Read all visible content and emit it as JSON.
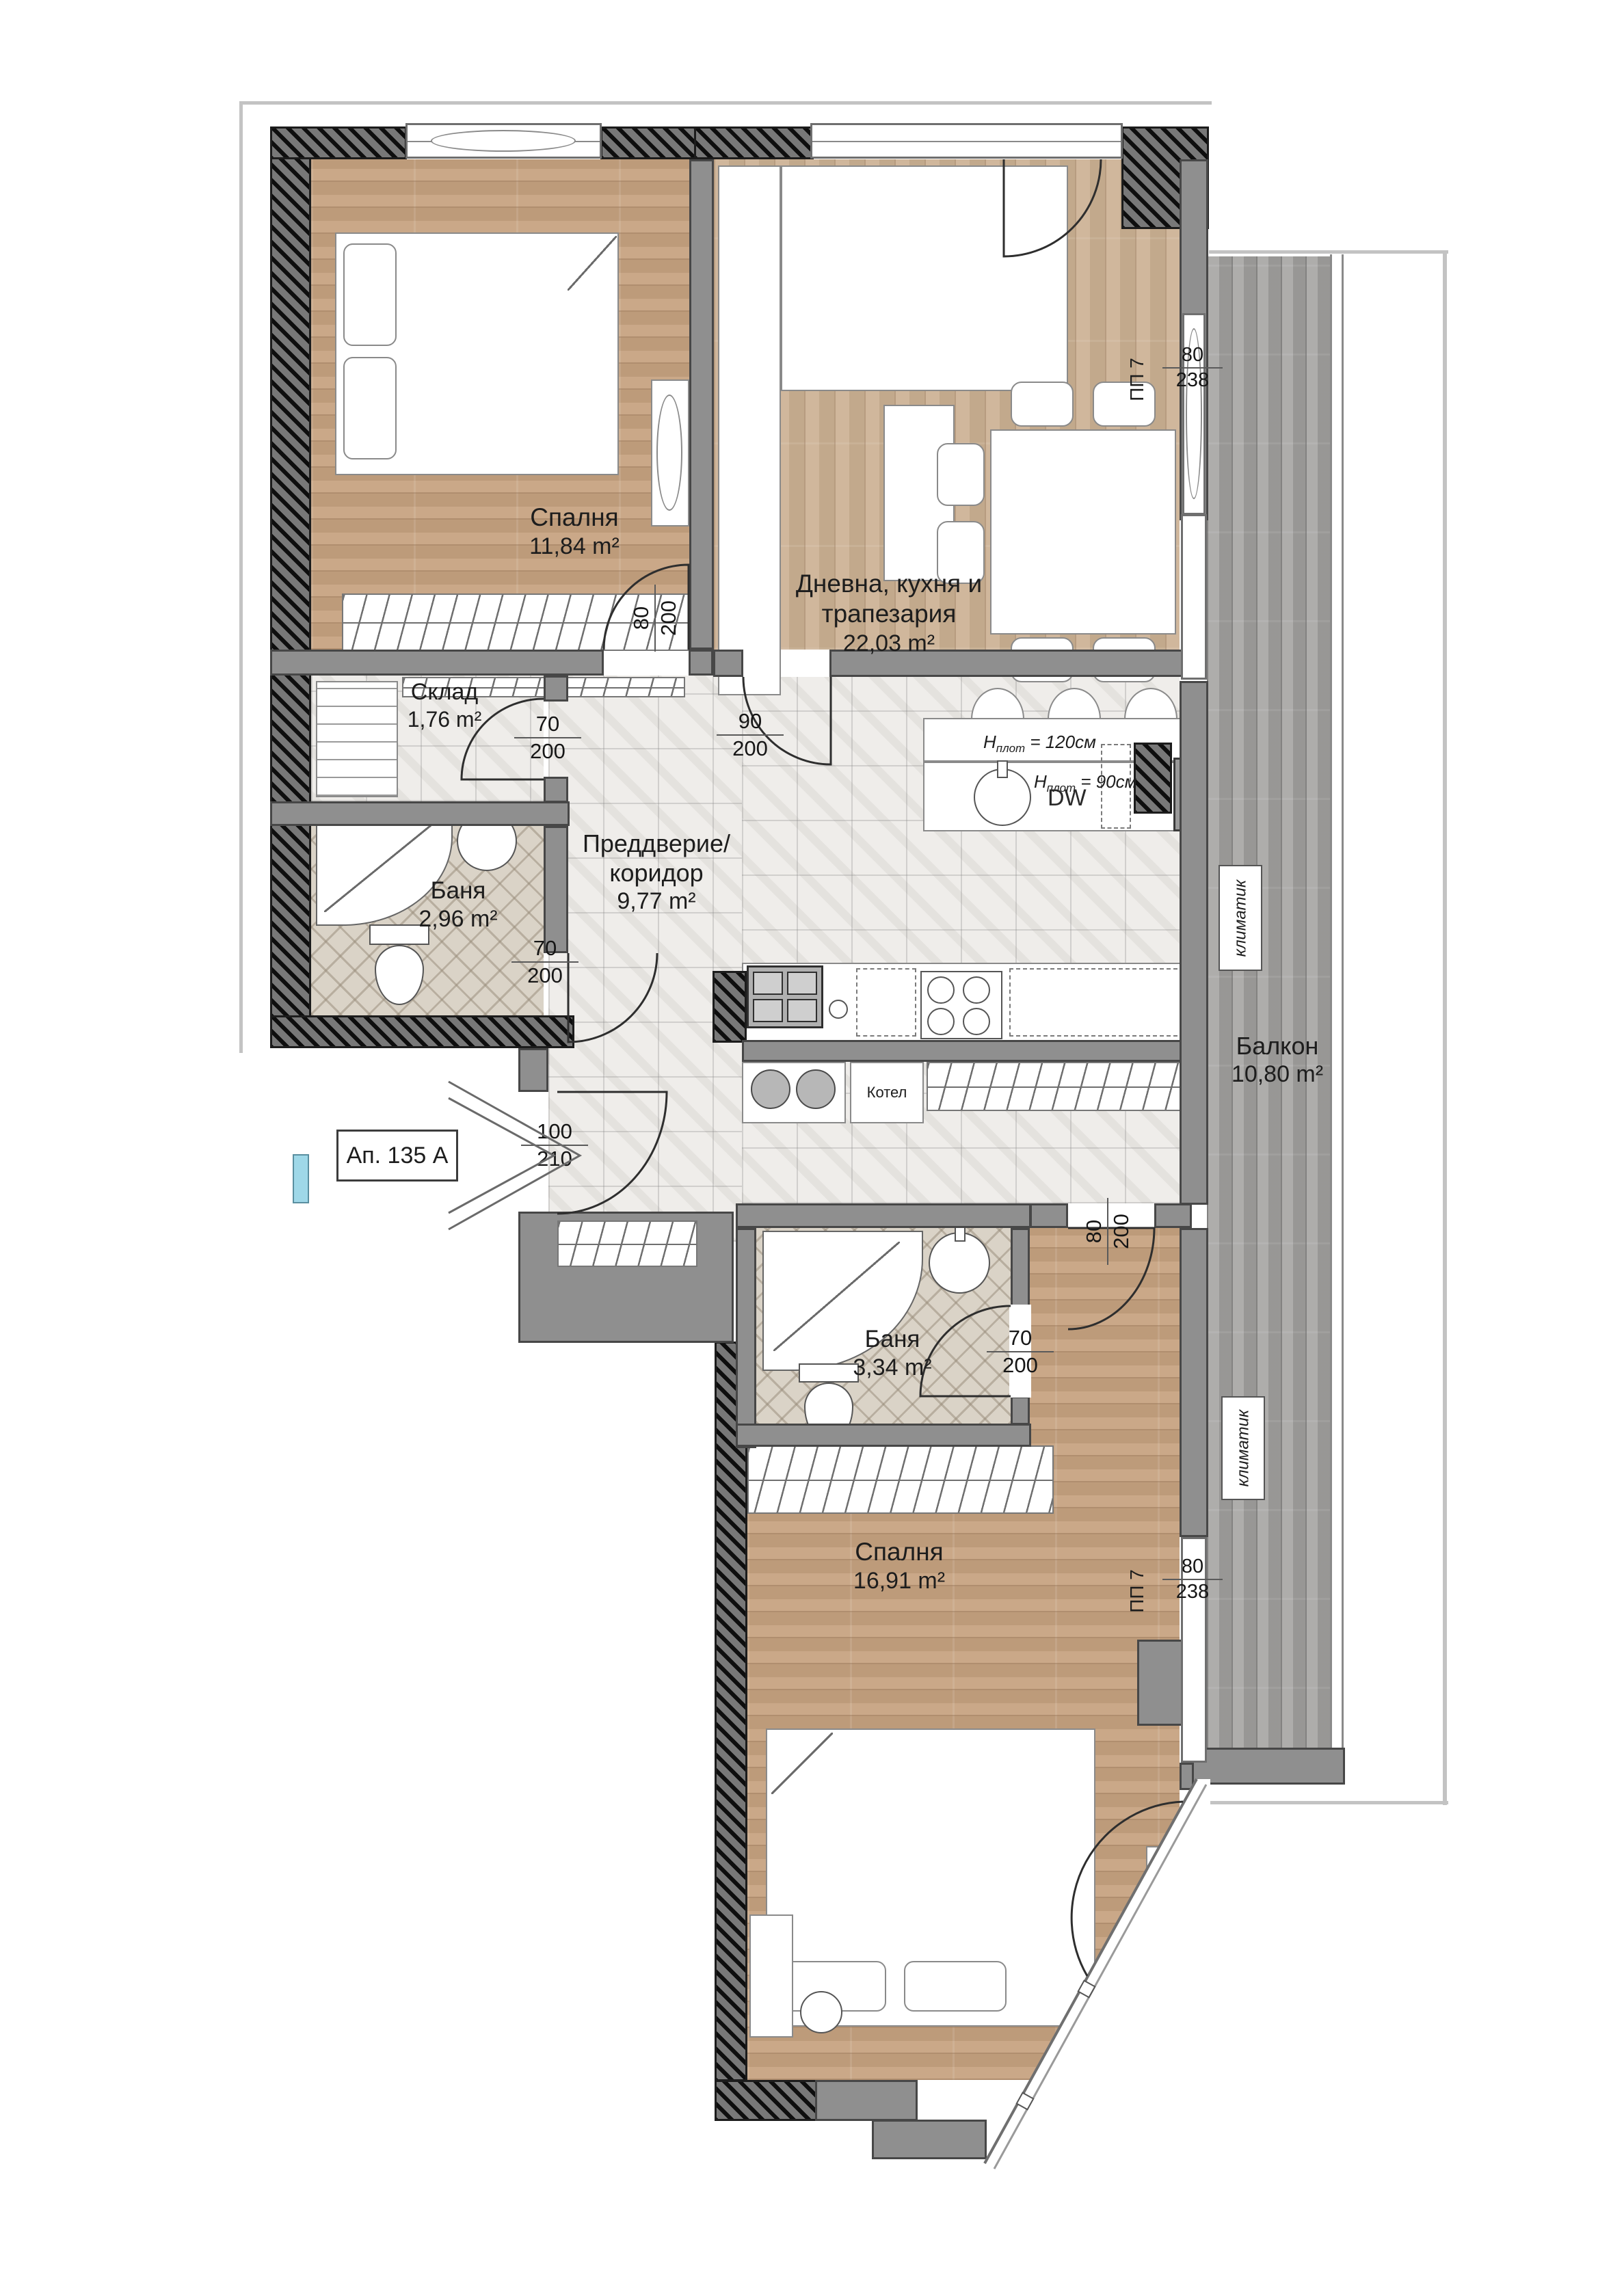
{
  "apartment": {
    "label": "Ап. 135 А"
  },
  "rooms": {
    "bedroom1": {
      "name": "Спалня",
      "area": "11,84 m²"
    },
    "living": {
      "name_line1": "Дневна, кухня и",
      "name_line2": "трапезария",
      "area": "22,03 m²"
    },
    "storage": {
      "name": "Склад",
      "area": "1,76 m²"
    },
    "bath1": {
      "name": "Баня",
      "area": "2,96 m²"
    },
    "hall": {
      "name_line1": "Преддверие/",
      "name_line2": "коридор",
      "area": "9,77 m²"
    },
    "bath2": {
      "name": "Баня",
      "area": "3,34 m²"
    },
    "bedroom2": {
      "name": "Спалня",
      "area": "16,91 m²"
    },
    "balcony": {
      "name": "Балкон",
      "area": "10,80 m²"
    }
  },
  "doors": {
    "bedroom1": {
      "w": "80",
      "h": "200"
    },
    "storage": {
      "w": "70",
      "h": "200"
    },
    "living": {
      "w": "90",
      "h": "200"
    },
    "bath1": {
      "w": "70",
      "h": "200"
    },
    "entrance": {
      "w": "100",
      "h": "210"
    },
    "bedroom2": {
      "w": "80",
      "h": "200"
    },
    "bath2": {
      "w": "70",
      "h": "200"
    }
  },
  "windows": {
    "top_right": {
      "code": "ПП 7",
      "w": "80",
      "h": "238"
    },
    "bottom_right": {
      "code": "ПП 7",
      "w": "80",
      "h": "238"
    }
  },
  "equipment": {
    "boiler": "Котел",
    "ac": "климатик",
    "dishwasher": "DW",
    "counter_letter": "H",
    "counter_sub": "плот",
    "counter_high": "= 120см",
    "counter_low": "= 90см"
  },
  "colors": {
    "wall": "#8f8f8f",
    "wall_dark": "#5a5a5a",
    "wood": "#c7a381",
    "tile": "#efedea",
    "accent_shaft": "#9fd8e8"
  }
}
